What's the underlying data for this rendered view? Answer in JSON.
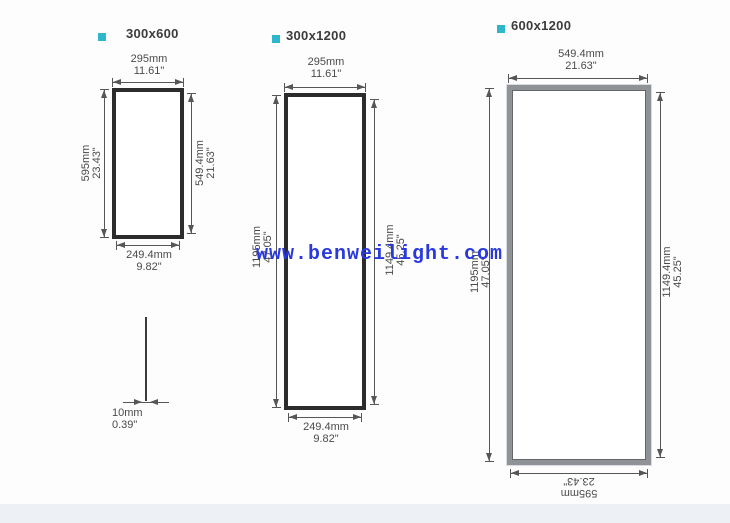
{
  "watermark": {
    "text": "www.benweilight.com",
    "color": "#2939de"
  },
  "panels": [
    {
      "title": "300x600",
      "top_mm": "295mm",
      "top_in": "11.61\"",
      "left_mm": "595mm",
      "left_in": "23.43\"",
      "right_mm": "549.4mm",
      "right_in": "21.63\"",
      "bottom_mm": "249.4mm",
      "bottom_in": "9.82\""
    },
    {
      "title": "300x1200",
      "top_mm": "295mm",
      "top_in": "11.61\"",
      "left_mm": "1195mm",
      "left_in": "47.05\"",
      "right_mm": "1149.4mm",
      "right_in": "45.25\"",
      "bottom_mm": "249.4mm",
      "bottom_in": "9.82\""
    },
    {
      "title": "600x1200",
      "top_mm": "549.4mm",
      "top_in": "21.63\"",
      "left_mm": "1195mm",
      "left_in": "47.05\"",
      "right_mm": "1149.4mm",
      "right_in": "45.25\"",
      "bottom_mm": "595mm",
      "bottom_in": "23.43\""
    }
  ],
  "thickness": {
    "mm": "10mm",
    "in": "0.39\""
  },
  "colors": {
    "accent_square": "#2fb6ca",
    "frame_dark": "#2c2c2c",
    "frame_silver": "#8f9296",
    "dimension_lines": "#565656",
    "watermark_blue": "#2939de",
    "bottom_strip": "#edf0f4"
  }
}
